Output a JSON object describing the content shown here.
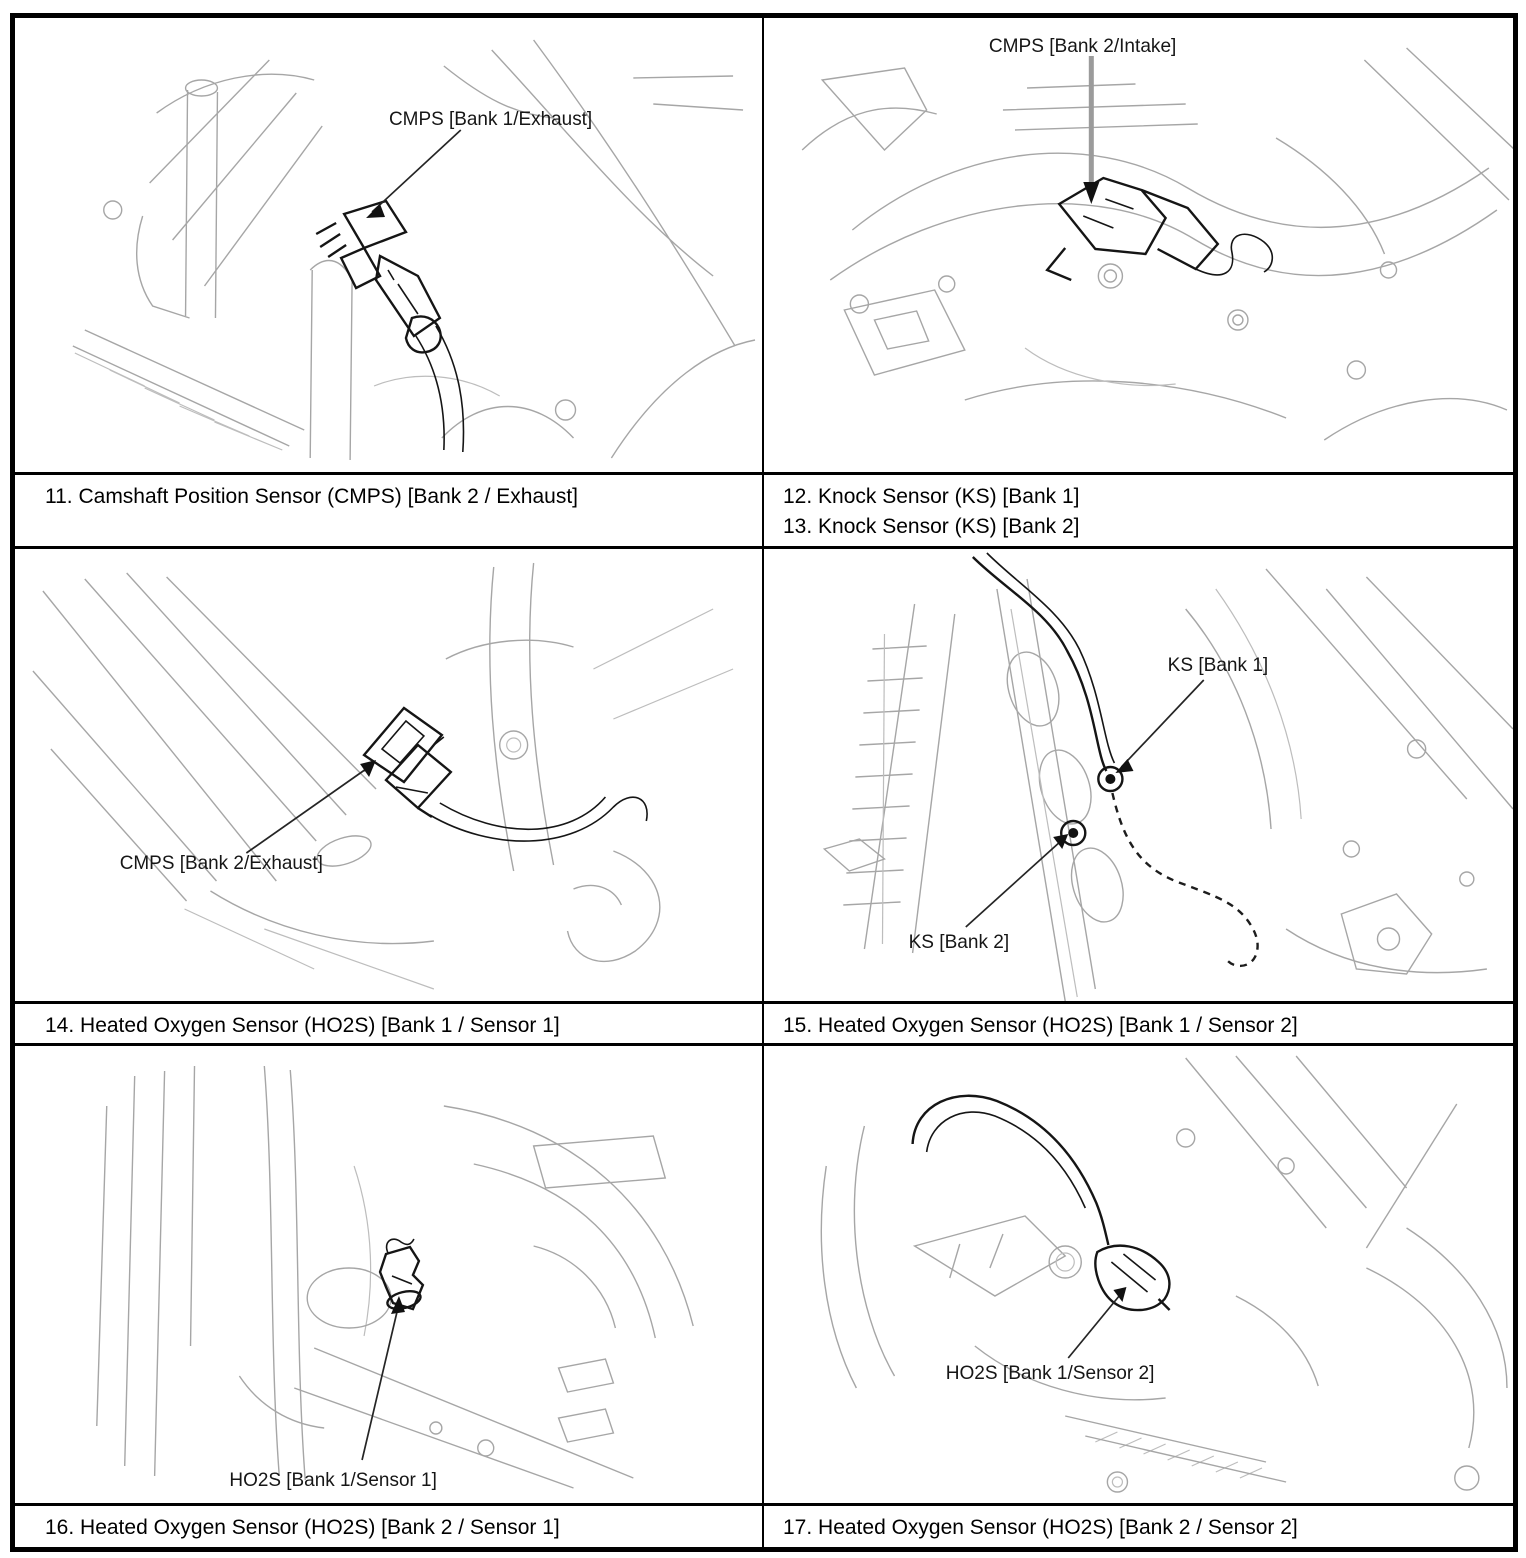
{
  "page": {
    "background": "#ffffff",
    "line_color": "#000000",
    "art_gray": "#a6a6a6"
  },
  "cells": {
    "c11": {
      "diagram_label": "CMPS [Bank 1/Exhaust]",
      "caption": "11. Camshaft Position Sensor (CMPS) [Bank 2 / Exhaust]"
    },
    "c12": {
      "diagram_label": "CMPS [Bank 2/Intake]",
      "caption_line1": "12. Knock Sensor (KS) [Bank 1]",
      "caption_line2": "13. Knock Sensor (KS) [Bank 2]"
    },
    "c14": {
      "diagram_label": "CMPS [Bank 2/Exhaust]",
      "caption": "14. Heated Oxygen Sensor (HO2S) [Bank 1 / Sensor 1]"
    },
    "c15": {
      "diagram_label_ks1": "KS [Bank 1]",
      "diagram_label_ks2": "KS [Bank 2]",
      "caption": "15. Heated Oxygen Sensor (HO2S) [Bank 1 / Sensor 2]"
    },
    "c16": {
      "diagram_label": "HO2S [Bank 1/Sensor 1]",
      "caption": "16. Heated Oxygen Sensor (HO2S) [Bank 2 / Sensor 1]"
    },
    "c17": {
      "diagram_label": "HO2S [Bank 1/Sensor 2]",
      "caption": "17. Heated Oxygen Sensor (HO2S) [Bank 2 / Sensor 2]"
    }
  }
}
